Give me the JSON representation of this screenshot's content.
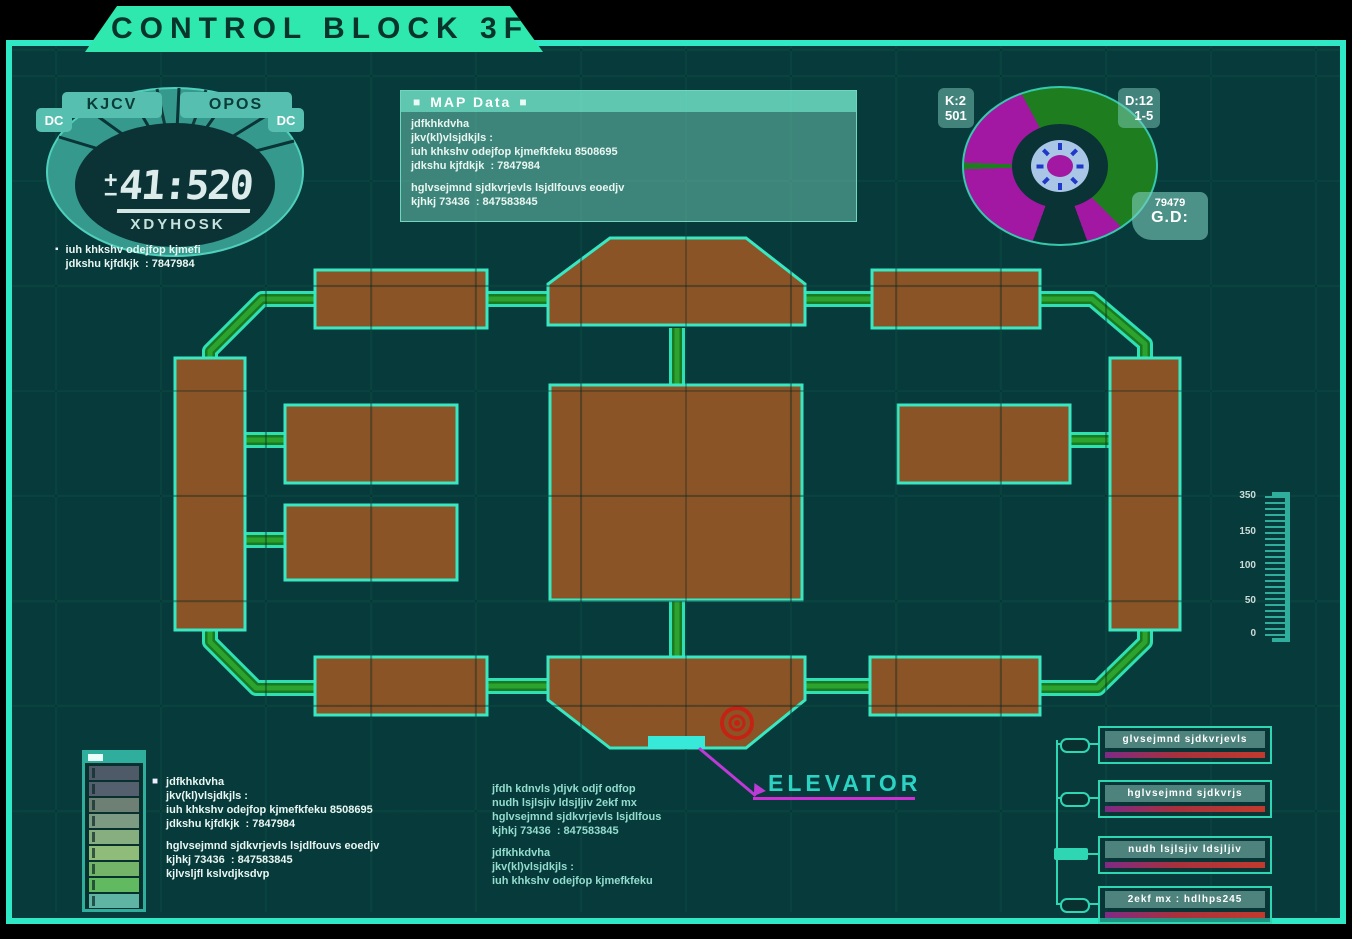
{
  "title": "CONTROL BLOCK 3F",
  "markers": {
    "square": "■",
    "small_square": "▪"
  },
  "gauge": {
    "label_left": "KJCV",
    "label_right": "OPOS",
    "side_left": "DC",
    "side_right": "DC",
    "sign_plus": "+",
    "sign_minus": "−",
    "readout": "41:520",
    "caption": "XDYHOSK",
    "note_lines": [
      "iuh khkshv odejfop kjmefi",
      "jdkshu kjfdkjk  : 7847984"
    ]
  },
  "map_data_panel": {
    "title": "MAP Data",
    "block1": [
      "jdfkhkdvha",
      "jkv(kl)vlsjdkjls :",
      "iuh khkshv odejfop kjmefkfeku 8508695",
      "jdkshu kjfdkjk  : 7847984"
    ],
    "block2": [
      "hglvsejmnd sjdkvrjevls lsjdlfouvs eoedjv",
      "kjhkj 73436  : 847583845"
    ]
  },
  "pie": {
    "top_left_label": "K:2",
    "top_left_value": "501",
    "top_right_label": "D:12",
    "top_right_value": "1-5",
    "bottom_value": "79479",
    "bottom_label": "G.D:",
    "segments": {
      "green_deg": [
        0,
        135
      ],
      "magenta_deg": [
        135,
        332
      ],
      "dark_wedge_deg": [
        160,
        200
      ]
    },
    "colors": {
      "green": "#1e7d1e",
      "magenta": "#a218a2",
      "rose_ring": "#a9c6e6",
      "tick_blue": "#2038c8"
    }
  },
  "scale": {
    "labels": [
      "350",
      "150",
      "100",
      "50",
      "0"
    ]
  },
  "legend_left": {
    "bar_colors": [
      "#4e5a68",
      "#55606e",
      "#6e7f74",
      "#7d9a82",
      "#87ae7e",
      "#8fbc78",
      "#74b468",
      "#62ba60",
      "#5fb4a4"
    ]
  },
  "notes_left": {
    "block1": [
      "jdfkhkdvha",
      "jkv(kl)vlsjdkjls :",
      "iuh khkshv odejfop kjmefkfeku 8508695",
      "jdkshu kjfdkjk  : 7847984"
    ],
    "block2": [
      "hglvsejmnd sjdkvrjevls lsjdlfouvs eoedjv",
      "kjhkj 73436  : 847583845",
      "kjlvsljfl kslvdjksdvp"
    ]
  },
  "notes_center": {
    "block1": [
      "jfdh kdnvls )djvk odjf odfop",
      "nudh lsjlsjiv ldsjljiv 2ekf mx",
      "hglvsejmnd sjdkvrjevls lsjdlfous",
      "kjhkj 73436  : 847583845"
    ],
    "block2": [
      "jdfkhkdvha",
      "jkv(kl)vlsjdkjls :",
      "iuh khkshv odejfop kjmefkfeku"
    ]
  },
  "legend_right": {
    "items": [
      {
        "label": "glvsejmnd sjdkvrjevls"
      },
      {
        "label": "hglvsejmnd sjdkvrjs"
      },
      {
        "label": "nudh lsjlsjiv ldsjljiv"
      },
      {
        "label": "2ekf mx : hdlhps245"
      }
    ]
  },
  "elevator": {
    "label": "ELEVATOR"
  },
  "colors": {
    "accent": "#2fe8c6",
    "panel_bg": "#073a3b",
    "room_brown": "#8a5426",
    "corridor_green": "#28a32e",
    "magenta_callout": "#c92fd4",
    "elevator_cyan": "#37e9d9",
    "target_red": "#c42314",
    "tab_green": "#2ee8ae"
  }
}
